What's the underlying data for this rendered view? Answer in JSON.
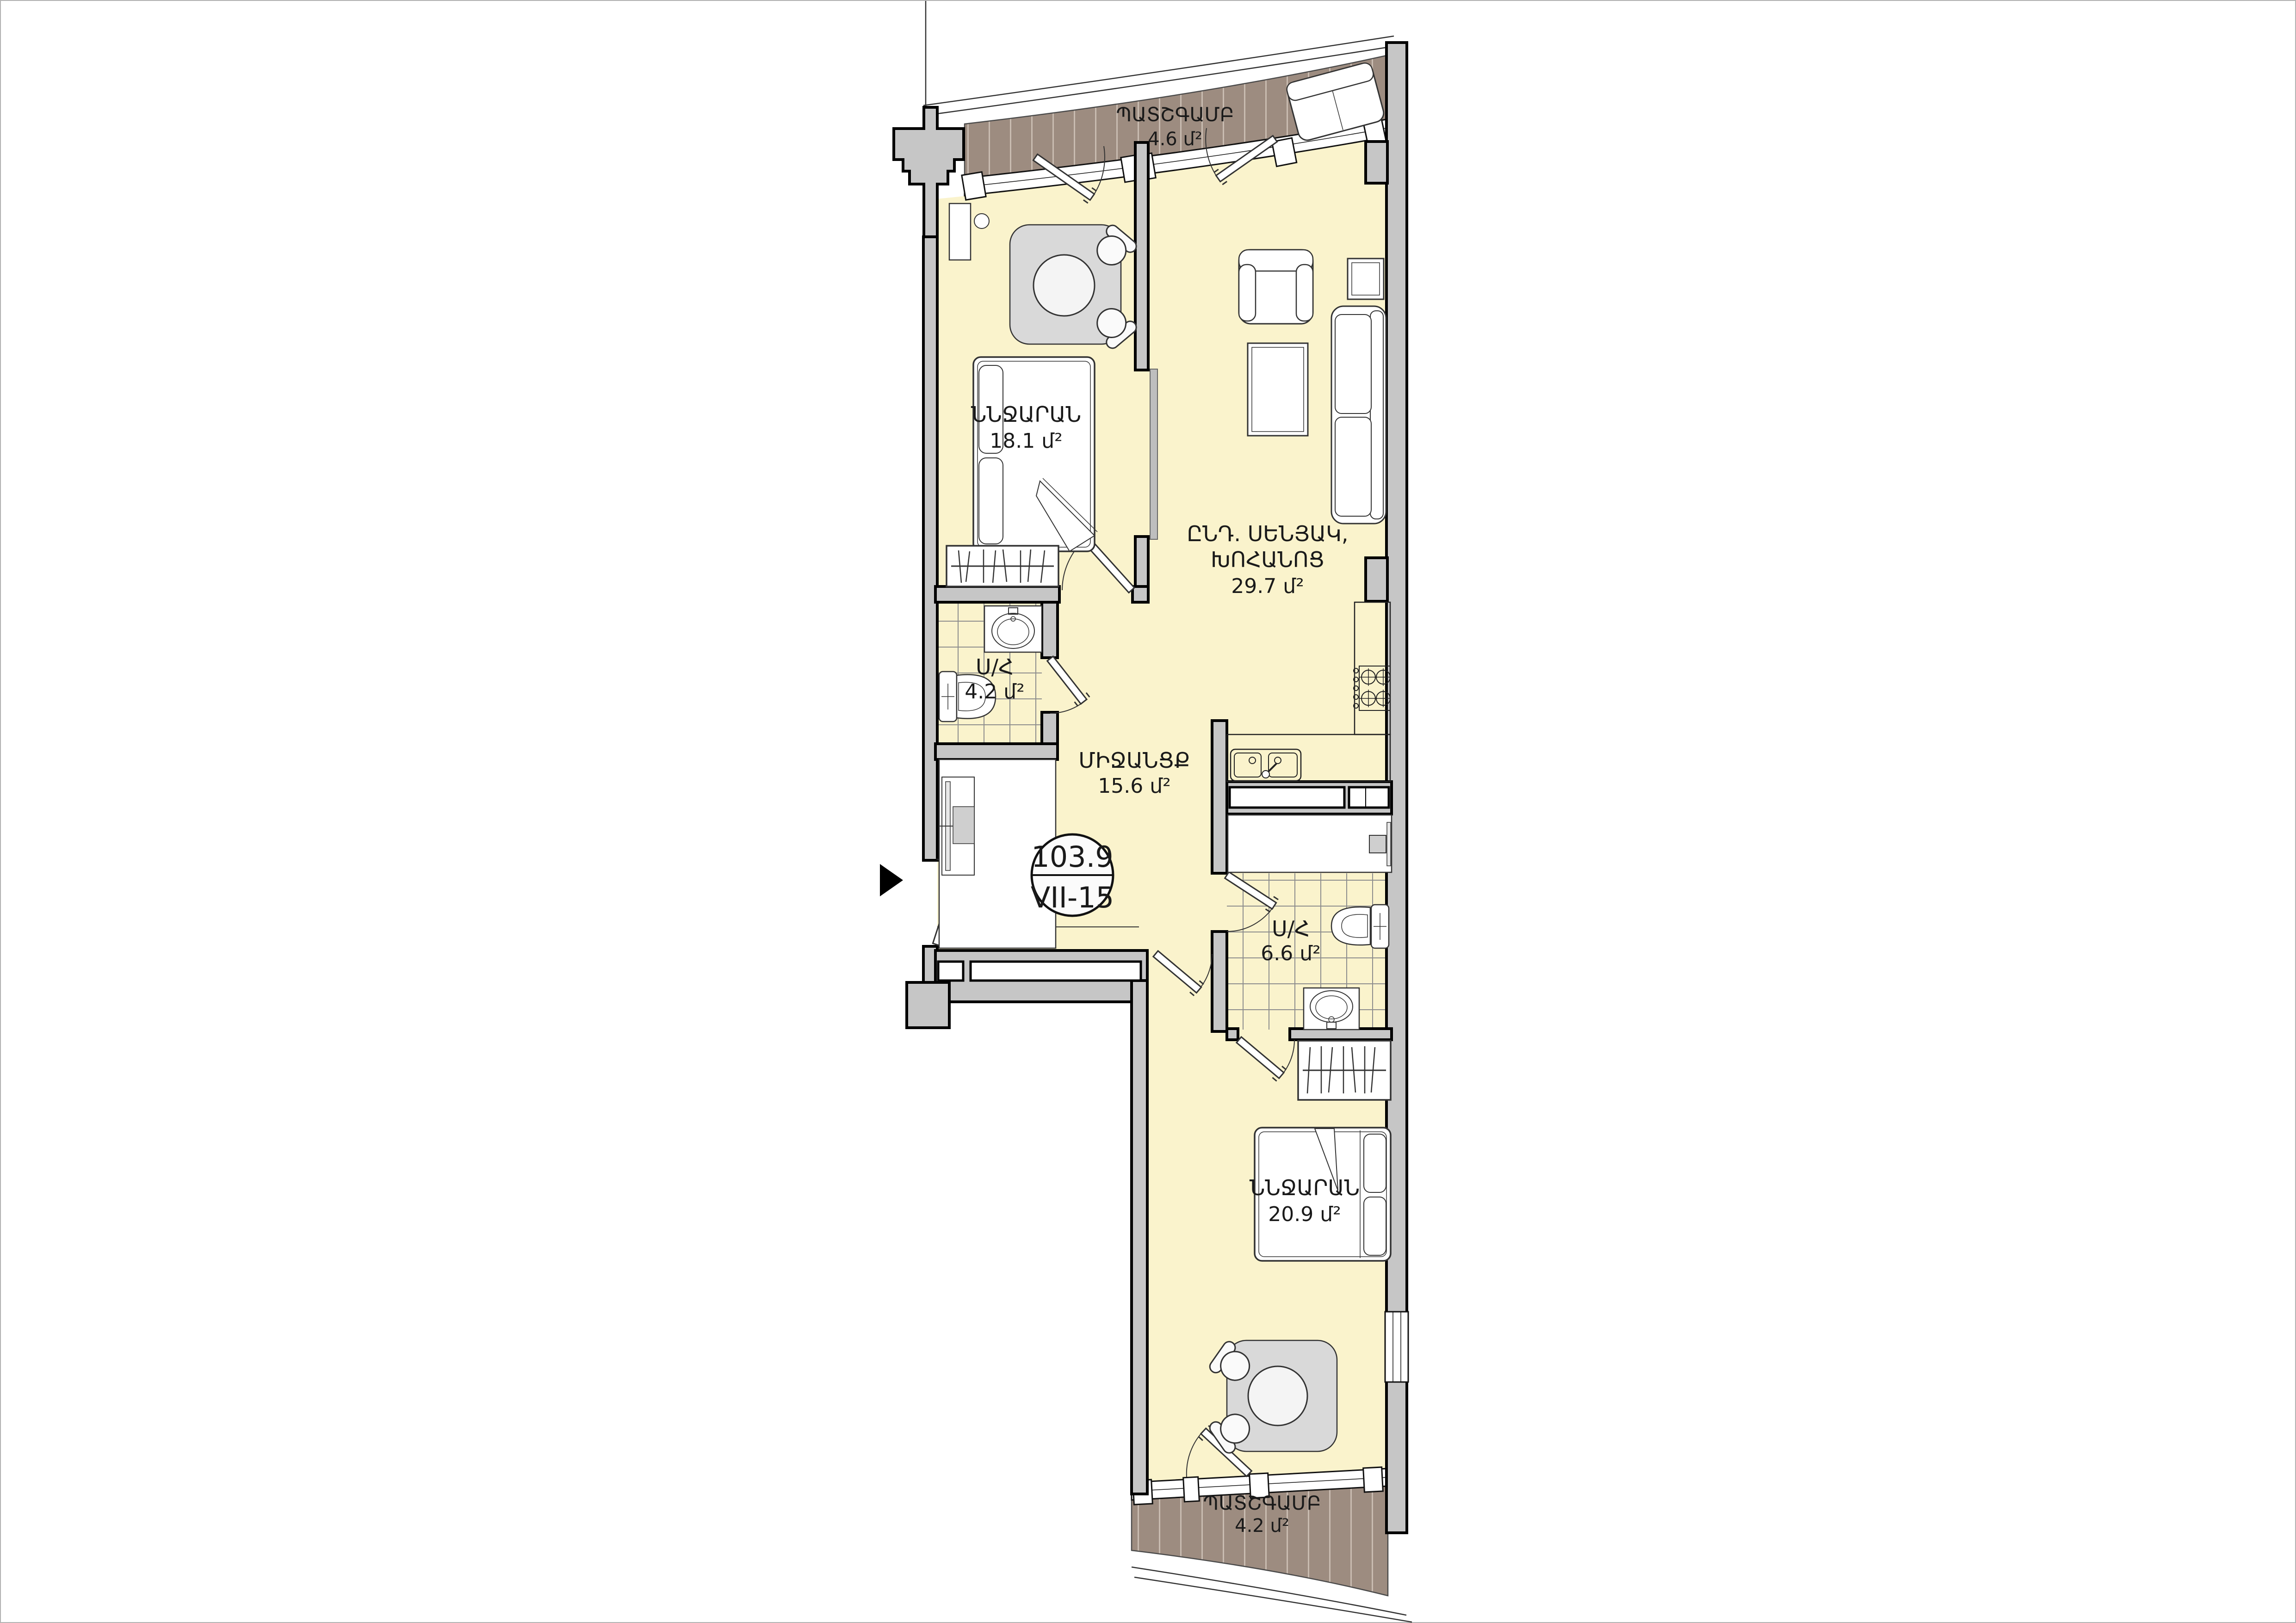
{
  "plan_labels": {
    "balcony_top": {
      "name": "ՊԱՏՇԳԱՄԲ",
      "area": "4.6 մ²"
    },
    "bedroom_1": {
      "name": "ՆՆՋԱՐԱՆ",
      "area": "18.1 մ²"
    },
    "living_kitchen": {
      "name_line_1": "ԸՆԴ. ՍԵՆՅԱԿ,",
      "name_line_2": "ԽՈՀԱՆՈՑ",
      "area": "29.7 մ²"
    },
    "bathroom_1": {
      "name": "Ս/Հ",
      "area": "4.2 մ²"
    },
    "hallway": {
      "name": "ՄԻՋԱՆՑՔ",
      "area": "15.6 մ²"
    },
    "bathroom_2": {
      "name": "Ս/Հ",
      "area": "6.6 մ²"
    },
    "bedroom_2": {
      "name": "ՆՆՋԱՐԱՆ",
      "area": "20.9 մ²"
    },
    "balcony_bottom": {
      "name": "ՊԱՏՇԳԱՄԲ",
      "area": "4.2 մ²"
    }
  },
  "unit_badge": {
    "total_area": "103.9",
    "unit_code": "VII-15"
  },
  "icons": {
    "entry_arrow": "entry-direction-arrow"
  },
  "colors": {
    "floor": "#FAF3CC",
    "wall_fill": "#C6C6C6",
    "wall_outline": "#000000",
    "deck": "#9D8C80",
    "deck_stripe": "#C9BCB1",
    "tile_line": "#8D8D8D",
    "rug": "#D9D9D9",
    "sliding_door": "#BEBEBE",
    "text": "#1A1A1A"
  }
}
